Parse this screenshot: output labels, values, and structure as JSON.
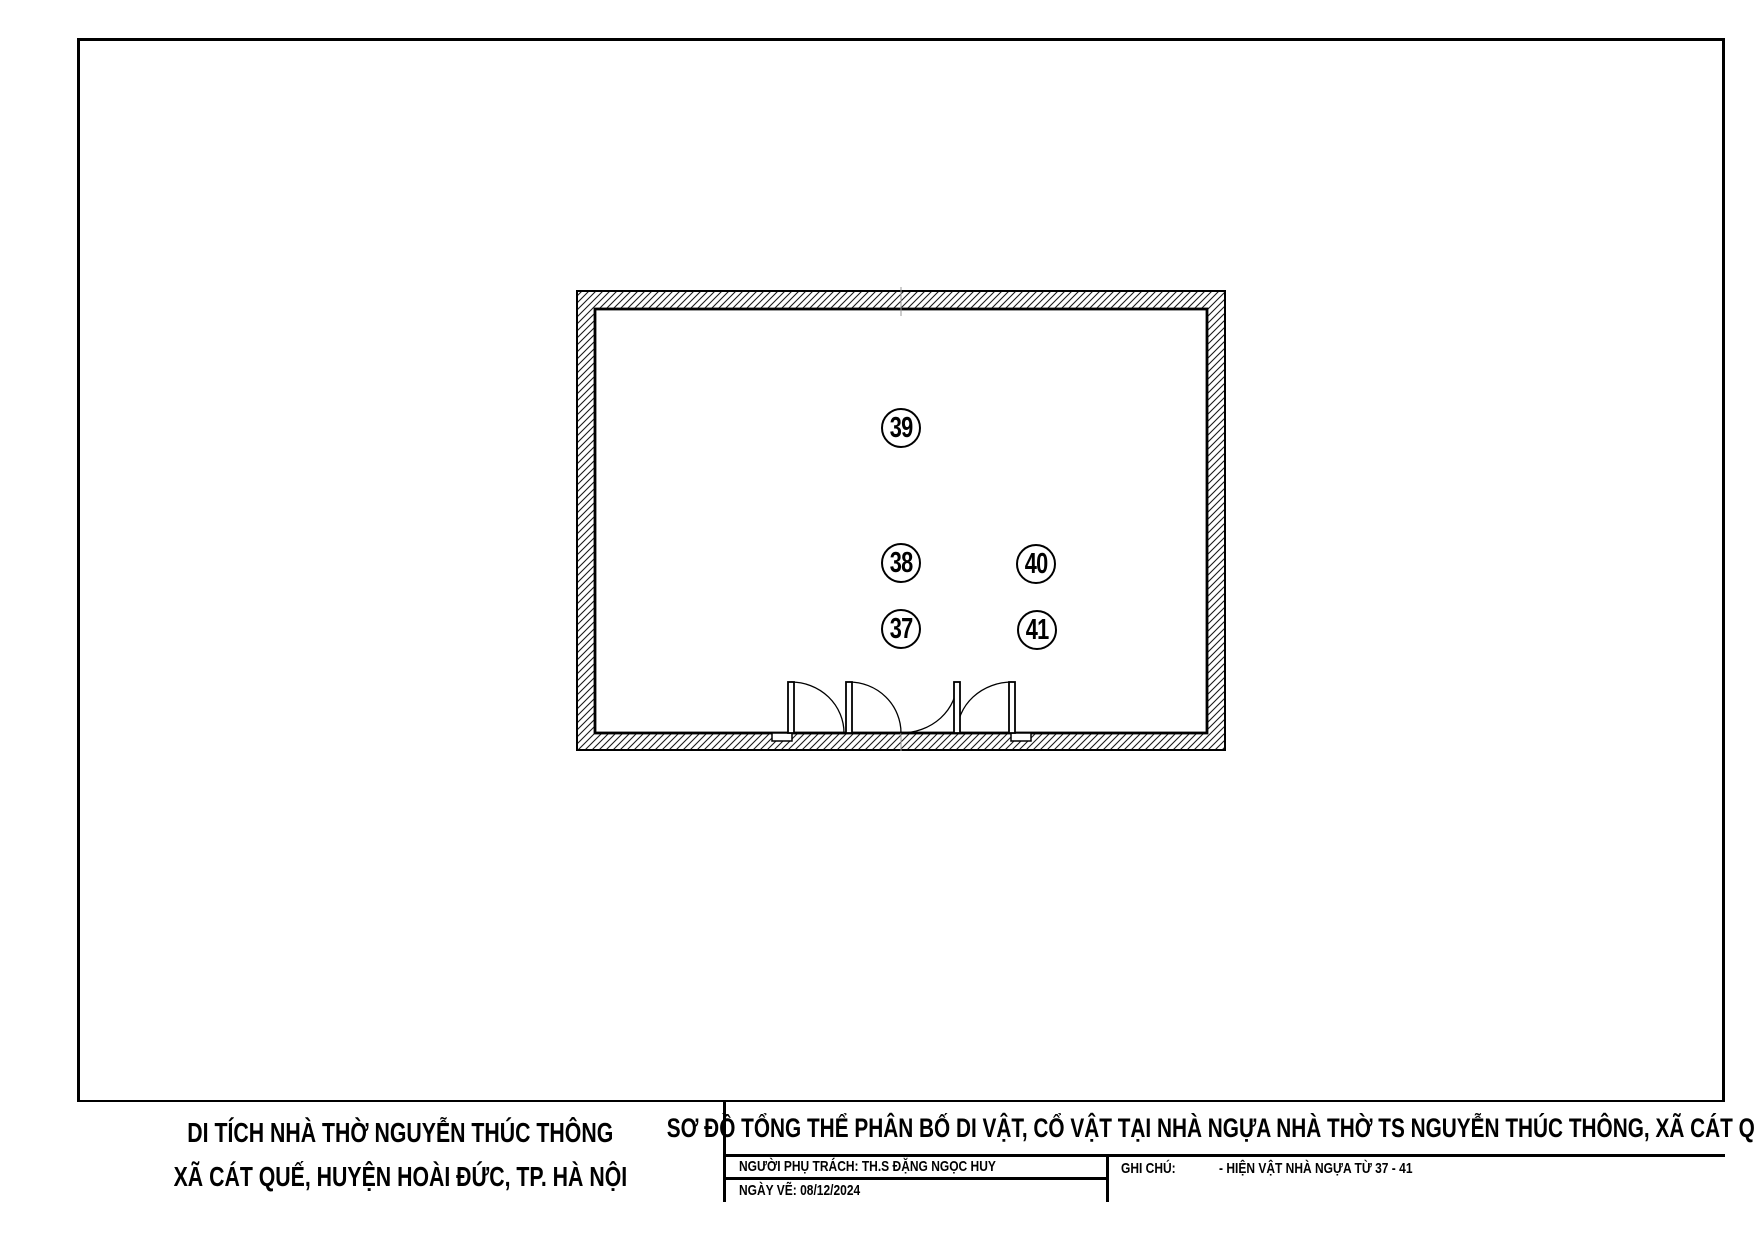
{
  "plan": {
    "markers": [
      {
        "label": "39",
        "x": 901,
        "y": 428
      },
      {
        "label": "38",
        "x": 901,
        "y": 563
      },
      {
        "label": "40",
        "x": 1036,
        "y": 564
      },
      {
        "label": "37",
        "x": 901,
        "y": 629
      },
      {
        "label": "41",
        "x": 1037,
        "y": 630
      }
    ]
  },
  "title_block": {
    "site_title_line1": "DI TÍCH NHÀ THỜ NGUYỄN THÚC THÔNG",
    "site_title_line2": "XÃ CÁT QUẾ, HUYỆN HOÀI ĐỨC, TP. HÀ NỘI",
    "drawing_title": "SƠ ĐỒ TỔNG THỂ PHÂN BỐ DI VẬT, CỔ VẬT TẠI NHÀ NGỰA NHÀ THỜ TS NGUYỄN THÚC THÔNG, XÃ CÁT QUẾ",
    "manager_label": "NGƯỜI PHỤ TRÁCH: TH.S ĐẶNG NGỌC HUY",
    "date_label": "NGÀY VẼ: 08/12/2024",
    "note_label": "GHI CHÚ:",
    "note_text": "- HIỆN VẬT NHÀ NGỰA TỪ 37 - 41"
  },
  "colors": {
    "ink": "#000000",
    "paper": "#ffffff",
    "centerline": "#999999"
  }
}
